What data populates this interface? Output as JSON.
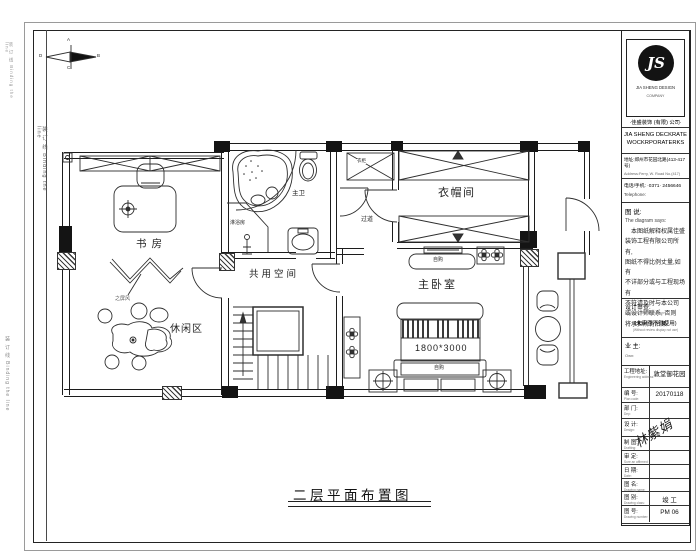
{
  "sheet": {
    "binding_text": "装 订 线 Binding the line",
    "drawing_title": "二层平面布置图",
    "compass": {
      "n": "A",
      "e": "B",
      "s": "C",
      "w": "D"
    }
  },
  "plan": {
    "labels": {
      "study": "书房",
      "leisure": "休闲区",
      "screen_note": "之屏风",
      "master_bath": "主卫",
      "shower": "淋浴房",
      "shared": "共用空间",
      "corridor": "过道",
      "closet_note": "衣柜",
      "cloakroom": "衣帽间",
      "bedroom": "主卧室",
      "tv_note": "自购",
      "bed_note": "自购",
      "bed_size": "1800*3000"
    }
  },
  "titleblock": {
    "logo_monogram": "JS",
    "logo_caption1": "JIA SHENG DESIGN",
    "logo_caption2": "COMPANY",
    "company_cn": "·佳盛装饰 (有限) 公司·",
    "company_en1": "JIA SHENG DECKRATE",
    "company_en2": "WOCKRPORATERKS",
    "address_cn": "地址:郑州市花园北路(413-417号)",
    "address_en": "Address:Ferry, W. Road No.(417)",
    "phone_cn": "电话/手机: ·0371· 2456646",
    "phone_en": "Telephone:",
    "note_label": "图 说:",
    "note_label_en": "The diagram says:",
    "disclaimer": [
      "本图纸解释权属佳盛",
      "装饰工程有限公司所有,",
      "图纸不得比例丈量,如有",
      "不详部分或与工程现场有",
      "不符请及时与本公司",
      "或设计师联系, 否则",
      "将承担所有后果."
    ],
    "review_label": "设计审查:",
    "review_label_en": "Design to enter the drawn:",
    "review_note": "(未审查不得使用)",
    "review_note_en": "(Without review display not use)",
    "owner_label": "业 主:",
    "owner_en": "Own:",
    "signature": "林紫娟",
    "rows": [
      {
        "label": "工程地址:",
        "en": "Engineering address:",
        "value": "敦堂御花园"
      },
      {
        "label": "编 号:",
        "en": "Plan code:",
        "value": "20170118"
      },
      {
        "label": "部 门:",
        "en": "Dep:",
        "value": ""
      },
      {
        "label": "设 计:",
        "en": "Design:",
        "value": ""
      },
      {
        "label": "制 图:",
        "en": "Drafting:",
        "value": ""
      },
      {
        "label": "审 定:",
        "en": "Sure an affirmed:",
        "value": ""
      },
      {
        "label": "日 期:",
        "en": "Date:",
        "value": ""
      },
      {
        "label": "图 名:",
        "en": "Drawing name:",
        "value": ""
      },
      {
        "label": "图 别:",
        "en": "Drawing class:",
        "value": "竣 工"
      },
      {
        "label": "图 号:",
        "en": "Drawing number:",
        "value": "PM 06"
      }
    ]
  }
}
